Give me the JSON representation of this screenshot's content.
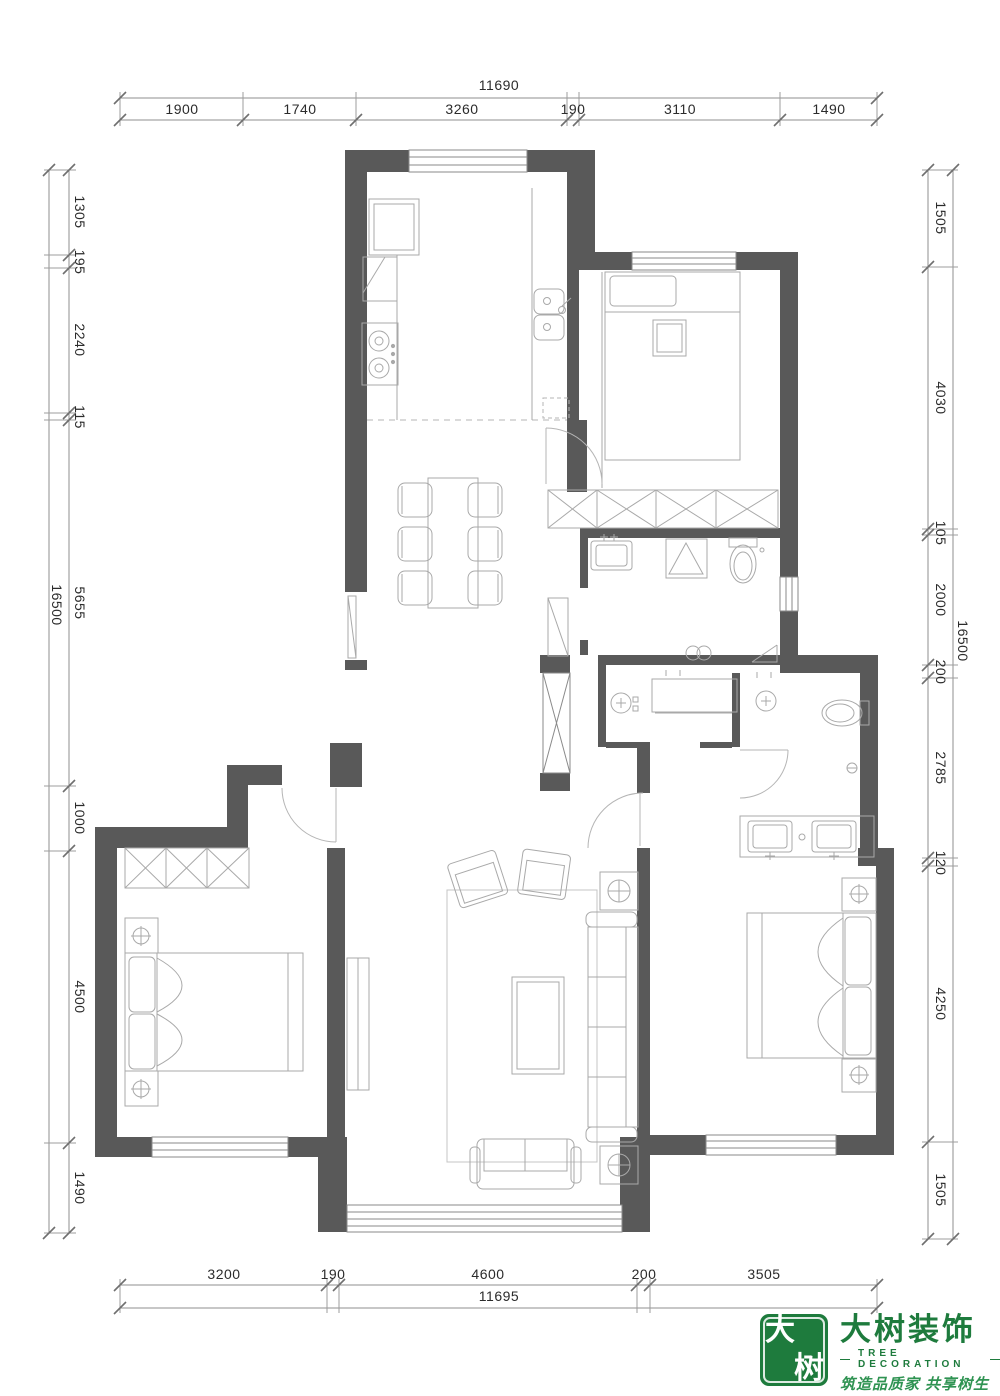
{
  "dims": {
    "top": {
      "total": "11690",
      "segments": [
        "1900",
        "1740",
        "3260",
        "190",
        "3110",
        "1490"
      ]
    },
    "bottom": {
      "total": "11695",
      "segments": [
        "3200",
        "190",
        "4600",
        "200",
        "3505"
      ]
    },
    "left": {
      "total": "16500",
      "segments": [
        "1305",
        "195",
        "2240",
        "115",
        "5655",
        "1000",
        "4500",
        "1490"
      ]
    },
    "right": {
      "total": "16500",
      "segments": [
        "1505",
        "4030",
        "105",
        "2000",
        "200",
        "2785",
        "120",
        "4250",
        "1505"
      ]
    }
  },
  "logo": {
    "seal_char_top": "大",
    "seal_char_bottom": "树",
    "brand": "大树装饰",
    "brand_en": "TREE DECORATION",
    "dash": "—",
    "slogan": "筑造品质家  共享树生活"
  },
  "colors": {
    "wall": "#595959",
    "furniture_line": "#a9a9a9",
    "dim_line": "#8f8f8f",
    "logo_green": "#1e7b3d"
  }
}
